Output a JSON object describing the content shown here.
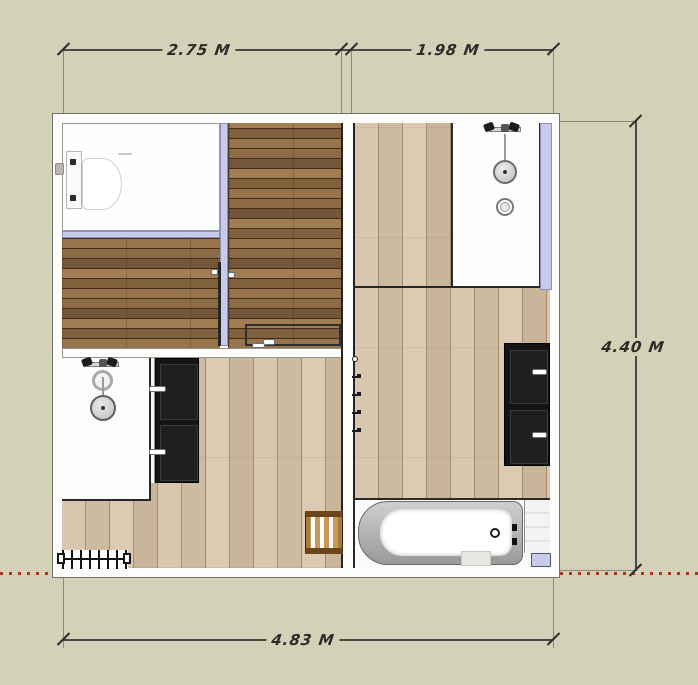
{
  "scene": {
    "type": "bathroom-floor-plan",
    "background_color": "#d3d1b8",
    "wall_accent_color": "#c7caec",
    "floor_dark_color": "#8b6a45",
    "floor_light_color": "#d3c2a9",
    "cabinet_color": "#141414",
    "dimension_color": "#2c2c2c",
    "red_guide_color": "#b5301c"
  },
  "dimensions": {
    "top_left": "2.75 M",
    "top_right": "1.98 M",
    "right": "4.40 M",
    "bottom": "4.83 M"
  },
  "fixtures": {
    "toilet": "wall-hung-toilet",
    "shower_top_right": "walk-in-shower",
    "shower_bottom_left": "walk-in-shower",
    "bathtub": "bathtub",
    "cabinet_bottom_left": "dark-cabinet",
    "cabinet_right": "dark-cabinet",
    "radiator": "radiator",
    "stool": "wooden-stool",
    "towel_hooks": "towel-hooks"
  }
}
